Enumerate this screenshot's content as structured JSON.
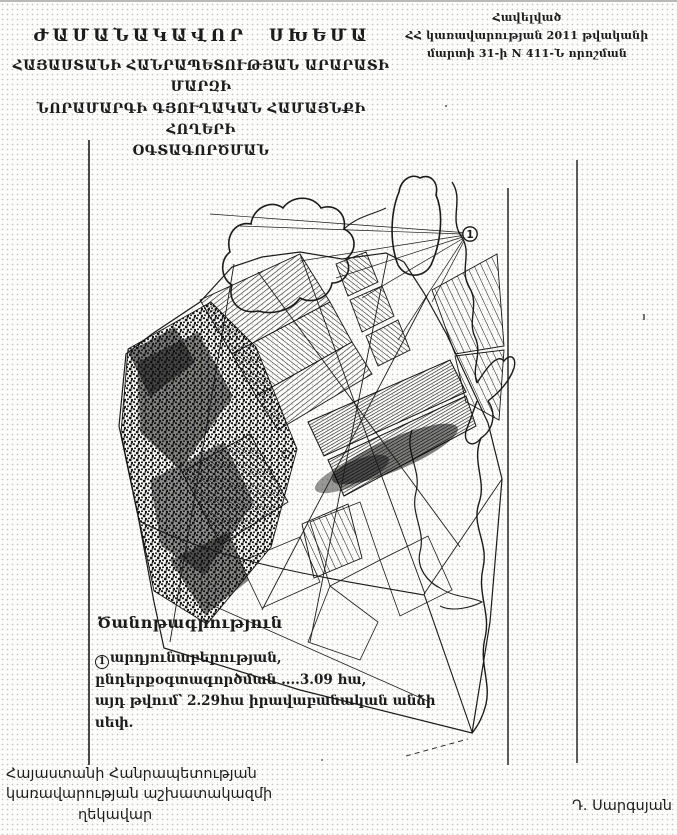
{
  "document": {
    "annex_lines": [
      "Հավելված",
      "ՀՀ կառավարության 2011 թվականի",
      "մարտի 31-ի N 411-Ն որոշման"
    ],
    "title": "ԺԱՄԱՆԱԿԱՎՈՐ ՍԽԵՄԱ",
    "subtitle_lines": [
      "ՀԱՅԱՍՏԱՆԻ ՀԱՆՐԱՊԵՏՈՒԹՅԱՆ ԱՐԱՐԱՏԻ ՄԱՐԶԻ",
      "ՆՈՐԱՄԱՐԳԻ ԳՅՈՒՂԱԿԱՆ ՀԱՄԱՅՆՔԻ ՀՈՂԵՐԻ",
      "ՕԳՏԱԳՈՐԾՄԱՆ"
    ]
  },
  "map": {
    "marker_label": "1"
  },
  "legend": {
    "heading": "Ծանոթագրություն",
    "ref_marker": "1",
    "line1_text": "արդյունաբերության,",
    "line2": "ընդերքօգտագործման ....3.09 հա,",
    "line3": "այդ թվում՝ 2.29հա իրավաբանական անձի սեփ."
  },
  "signature": {
    "left_lines": [
      "Հայաստանի Հանրապետության",
      "կառավարության աշխատակազմի",
      "ղեկավար"
    ],
    "right_name": "Դ. Սարգսյան"
  },
  "colors": {
    "ink": "#1c1c1c",
    "paper": "#fcfcfa",
    "halftone": "#c3c3c3"
  }
}
